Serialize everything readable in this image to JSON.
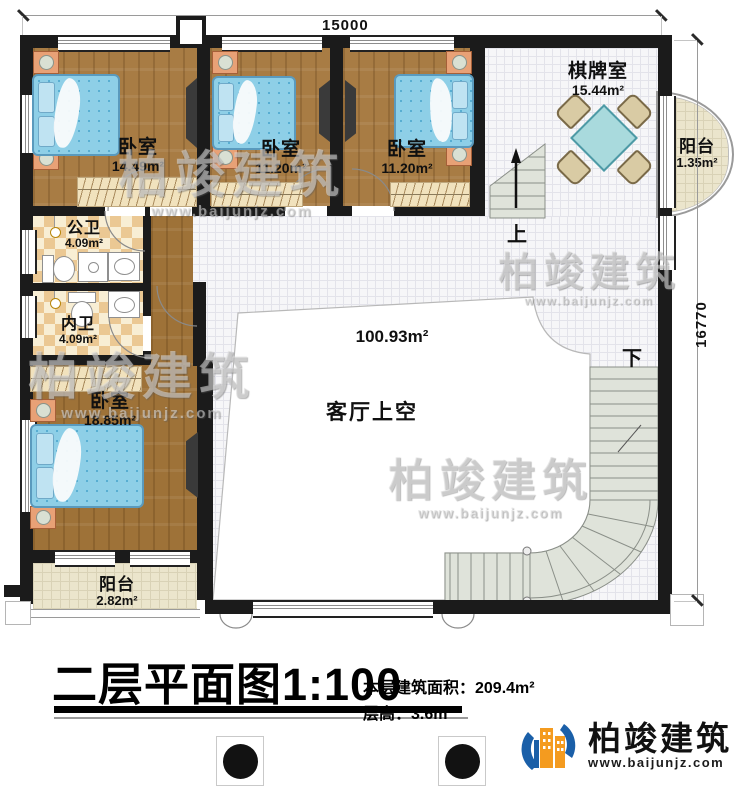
{
  "dimensions": {
    "top": "15000",
    "right": "16770"
  },
  "rooms": {
    "bedroom1": {
      "name": "卧室",
      "area": "14.49m²"
    },
    "bedroom2": {
      "name": "卧室",
      "area": "11.20m²"
    },
    "bedroom3": {
      "name": "卧室",
      "area": "11.20m²"
    },
    "bedroom4": {
      "name": "卧室",
      "area": "18.85m²"
    },
    "chess_room": {
      "name": "棋牌室",
      "area": "15.44m²"
    },
    "balcony_right": {
      "name": "阳台",
      "area": "1.35m²"
    },
    "balcony_bottom": {
      "name": "阳台",
      "area": "2.82m²"
    },
    "bath_public": {
      "name": "公卫",
      "area": "4.09m²"
    },
    "bath_inner": {
      "name": "内卫",
      "area": "4.09m²"
    },
    "living_void": {
      "name": "客厅上空",
      "area": "100.93m²"
    }
  },
  "stairs": {
    "up": "上",
    "down": "下"
  },
  "footer": {
    "title": "二层平面图1:100",
    "building_area_label": "本层建筑面积：209.4m²",
    "floor_height_label": "层高：3.6m"
  },
  "brand": {
    "name": "柏竣建筑",
    "website": "www.baijunjz.com"
  },
  "watermark": {
    "name": "柏竣建筑",
    "website": "www.baijunjz.com"
  },
  "colors": {
    "wall": "#1b1b1b",
    "wood_floor": "#a87c44",
    "bed_blue": "#8ecfe7",
    "tile": "#f6f6f8",
    "bath_checker": "#ebc893",
    "balcony": "#ebe5cc",
    "stair": "#dfe3da",
    "table_teal": "#a9dadd",
    "brand_blue": "#1a5fa8",
    "brand_orange": "#f49b1f"
  }
}
